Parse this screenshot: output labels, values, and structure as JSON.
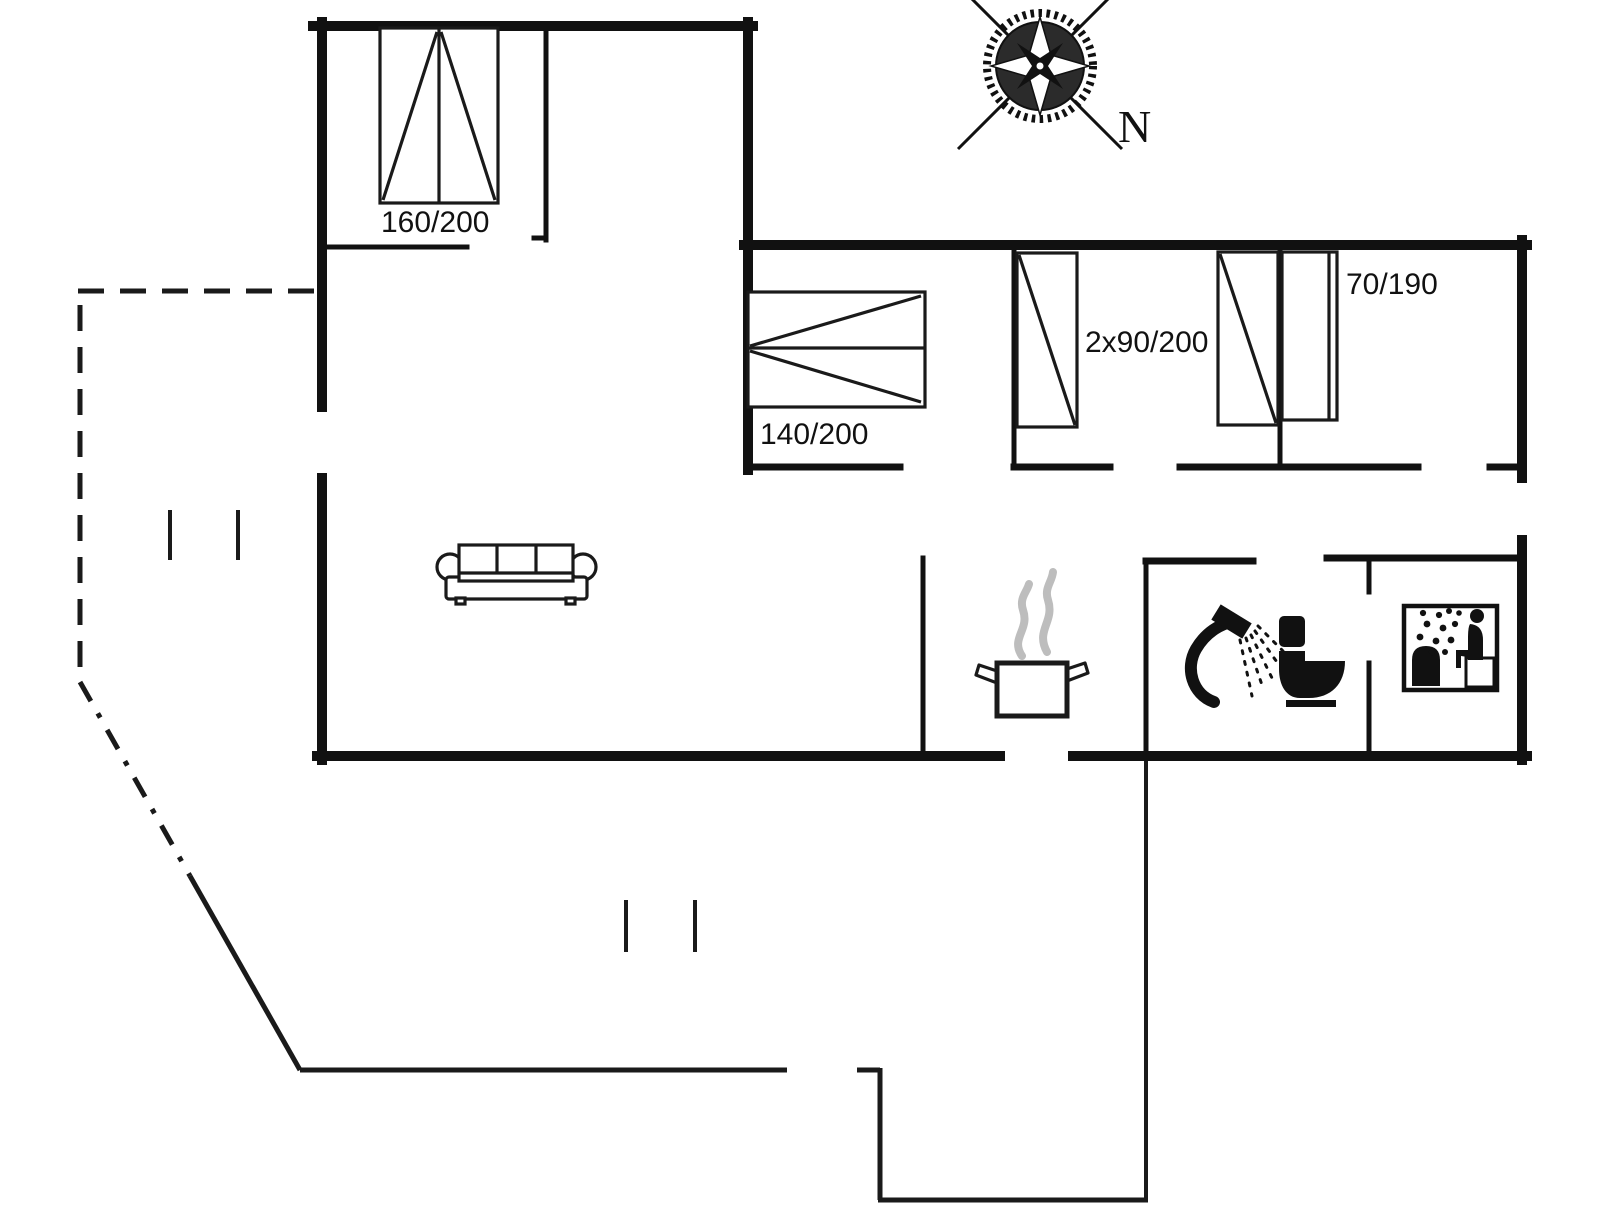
{
  "title": "House floor plan with terrace",
  "colors": {
    "background": "#ffffff",
    "lines": "#111111",
    "steam_grey": "#bdbdbd"
  },
  "labels": {
    "bed_160": "160/200",
    "bed_140": "140/200",
    "bed_2x90": "2x90/200",
    "bed_70": "70/190",
    "compass_north": "N"
  },
  "icons": {
    "compass_rose": "compass-rose-icon",
    "double_bed_top_left": "double-bed-icon",
    "double_bed_right_wing": "double-bed-icon",
    "single_bed_left": "single-bed-icon",
    "single_bed_right": "single-bed-icon",
    "narrow_bed": "narrow-bed-icon",
    "sofa": "sofa-icon",
    "cooking_pot": "cooking-pot-steam-icon",
    "shower": "shower-head-icon",
    "toilet": "toilet-icon",
    "sauna": "sauna-person-icon"
  },
  "structure": {
    "terrace_outline": "dashed-and-solid boundary, lower left",
    "entrance_walkway": "open gap in south wall with path to bottom edge",
    "door_gaps": [
      "living-room-west",
      "bedroom-1-south",
      "bedroom-2-south",
      "bedroom-3-south",
      "bathroom-north",
      "sauna-west",
      "kitchen-south-entrance"
    ]
  }
}
